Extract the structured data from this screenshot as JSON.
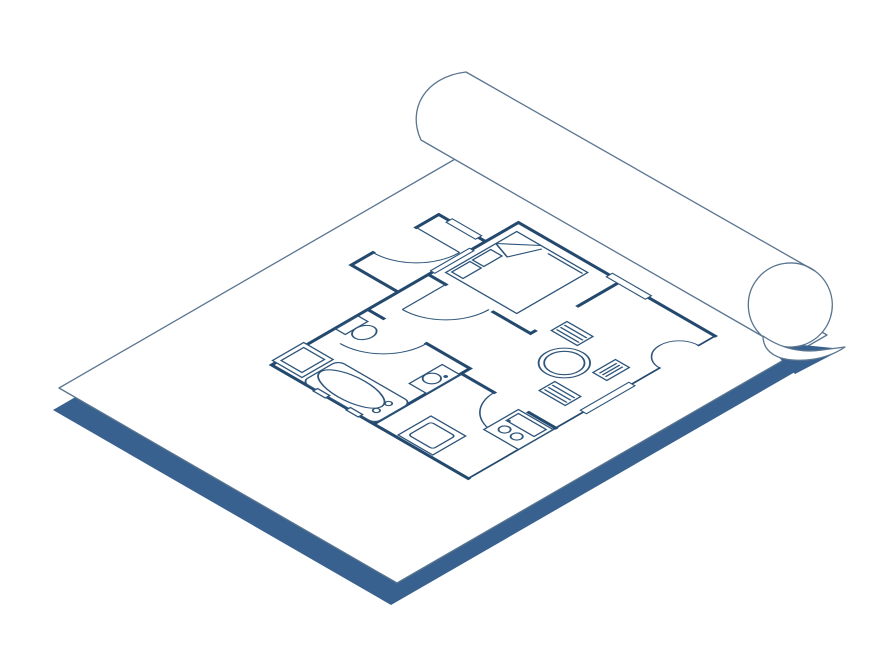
{
  "illustration": {
    "title": "Isometric rolled blueprint sheet with apartment floor plan drawing",
    "colors": {
      "background": "#ffffff",
      "ink": "#24496e",
      "ink_light": "#2d5479",
      "paper_outline": "#5a7590",
      "shadow": "#38618f",
      "paper": "#ffffff"
    },
    "paper": {
      "name": "blueprint-sheet",
      "style": "white sheet lying flat in isometric view with blue drop shadow"
    },
    "roll": {
      "name": "rolled-top-edge",
      "style": "upper edge of the sheet rolled into a cylinder with curled corner"
    },
    "floor_plan": {
      "rooms": [
        "bedroom",
        "hallway",
        "entry",
        "bathroom",
        "kitchen",
        "living-dining"
      ],
      "furniture": [
        "double-bed-with-pillows-and-folded-sheet",
        "round-dining-table",
        "three-chairs",
        "toilet",
        "bathtub",
        "washbasin",
        "washing-machine",
        "stove-counter",
        "kitchen-cabinet"
      ],
      "features": [
        "entry-door-arc",
        "bedroom-door-arc",
        "bathroom-door-arc",
        "kitchen-door-arc",
        "curved-wall-niche",
        "window-markers"
      ]
    }
  }
}
